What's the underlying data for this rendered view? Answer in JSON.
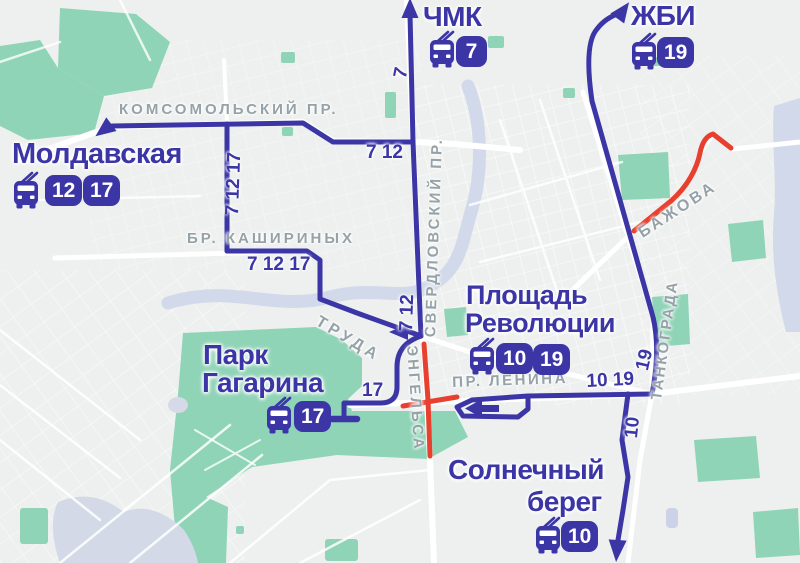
{
  "colors": {
    "route_line": "#3b35a6",
    "closed_segment": "#e8402f",
    "badge_bg": "#3b35a6",
    "badge_text": "#ffffff",
    "terminal_text": "#3b35a6",
    "street_label": "#95a2a8",
    "park": "#8fd4b7",
    "water": "#d2d9ea",
    "background": "#edf0ee"
  },
  "terminals": {
    "chmk": {
      "name": "ЧМК",
      "routes": [
        "7"
      ]
    },
    "zhbi": {
      "name": "ЖБИ",
      "routes": [
        "19"
      ]
    },
    "moldavskaya": {
      "name": "Молдавская",
      "routes": [
        "12",
        "17"
      ]
    },
    "ploshchad_revolyutsii": {
      "line1": "Площадь",
      "line2": "Революции",
      "routes": [
        "10",
        "19"
      ]
    },
    "park_gagarina": {
      "line1": "Парк",
      "line2": "Гагарина",
      "routes": [
        "17"
      ]
    },
    "solnechny_bereg": {
      "line1": "Солнечный",
      "line2": "берег",
      "routes": [
        "10"
      ]
    }
  },
  "streets": {
    "komsomolsky": "КОМСОМОЛЬСКИЙ ПР.",
    "kashirinykh": "БР. КАШИРИНЫХ",
    "sverdlovsky": "СВЕРДЛОВСКИЙ ПР.",
    "truda": "ТРУДА",
    "engelsa": "ЭНГЕЛЬСА",
    "lenina": "ПР. ЛЕНИНА",
    "bazhova": "БАЖОВА",
    "tankograda": "ТАНКОГРАДА"
  },
  "route_labels": {
    "sverdlovsky_north": "7",
    "komsomolsky_east": "7 12",
    "sverdlovsky_mid": "7 12",
    "west_branch": "7 12 17",
    "kashirinykh": "7 12 17",
    "gagarina_spur": "17",
    "lenina": "10 19",
    "tankograda_north": "19",
    "tankograda_south": "10"
  }
}
